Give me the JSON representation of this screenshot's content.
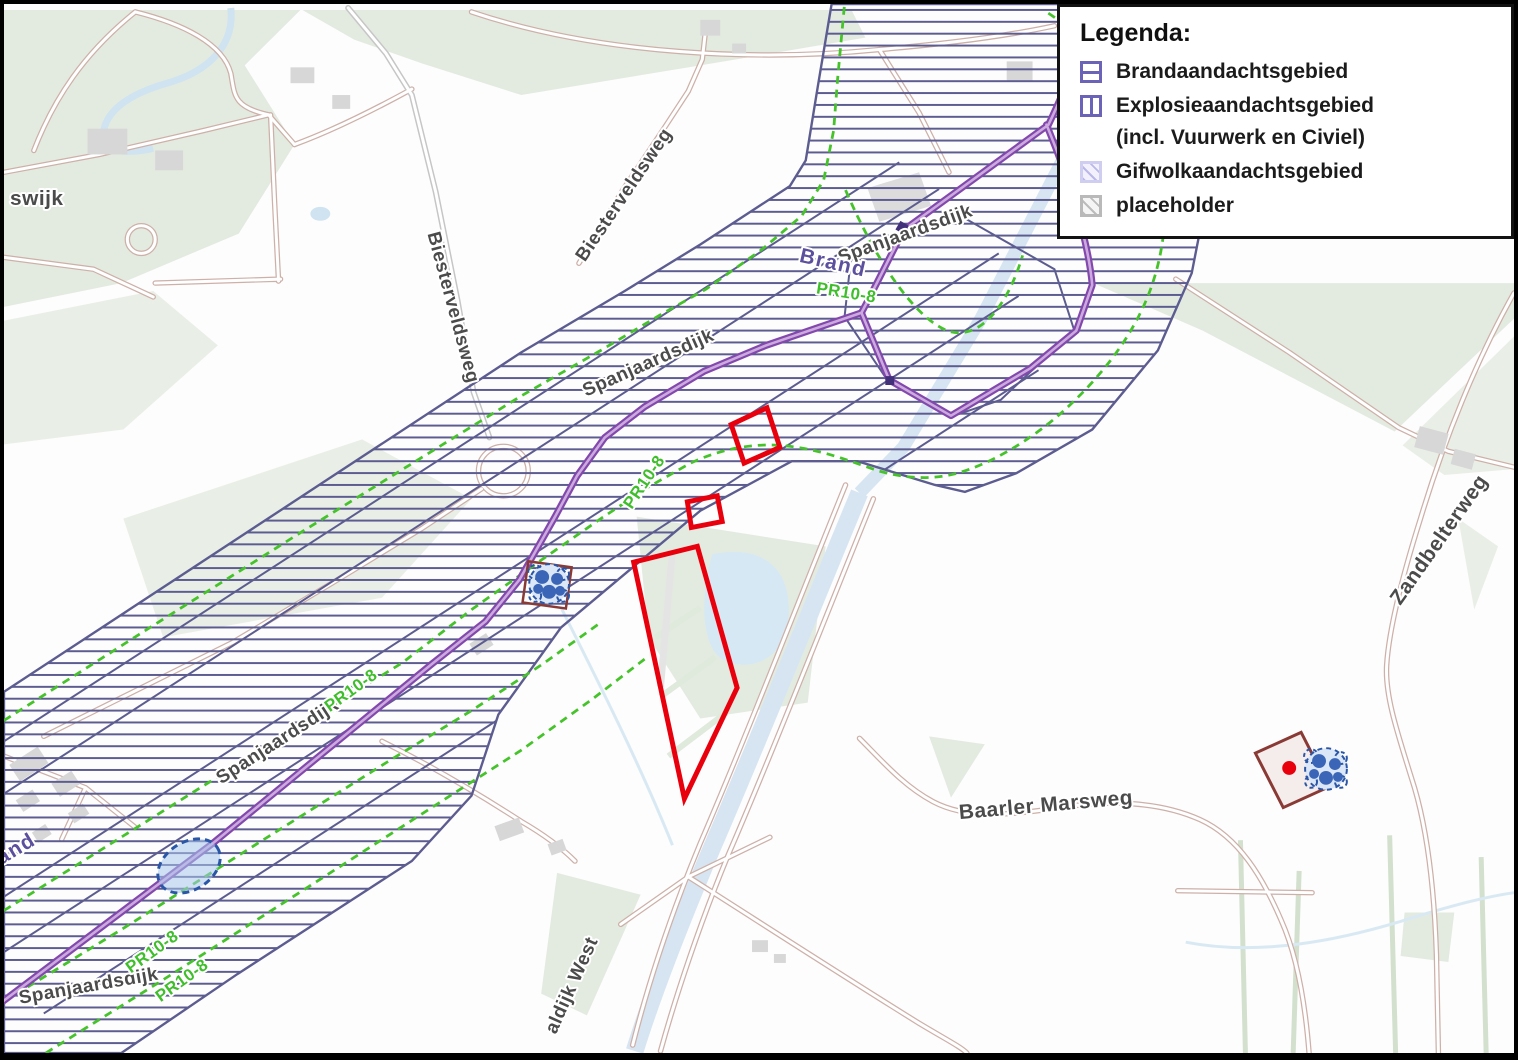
{
  "legend": {
    "title": "Legenda:",
    "items": [
      {
        "id": "brand",
        "label": "Brandaandachtsgebied",
        "swatch": "purple-square-hline",
        "color": "#6b63b8"
      },
      {
        "id": "explosie",
        "label": "Explosieaandachtsgebied",
        "swatch": "purple-square-vline",
        "color": "#6b63b8"
      },
      {
        "id": "explosie-note",
        "label": "(incl. Vuurwerk en Civiel)",
        "swatch": "none"
      },
      {
        "id": "gifwolk",
        "label": "Gifwolkaandachtsgebied",
        "swatch": "lavender-hatch",
        "color": "#cfcdf0"
      },
      {
        "id": "placeholder",
        "label": "placeholder",
        "swatch": "gray-hatch",
        "color": "#b9b9b9"
      }
    ]
  },
  "map": {
    "road_labels": [
      "swijk",
      "Biesterveldsweg",
      "Biesterveldsweg",
      "Spanjaardsdijk",
      "Spanjaardsdijk",
      "Spanjaardsdijk",
      "Spanjaardsdijk",
      "Baarler Marsweg",
      "Zandbelterweg",
      "aldijk West"
    ],
    "hazard_route_labels": [
      "Brand",
      "Brand"
    ],
    "risk_contour_labels": [
      "PR10-8",
      "PR10-8",
      "PR10-8",
      "PR10-8",
      "PR10-8"
    ],
    "colors": {
      "hatch_area_outline": "#5c5c90",
      "hazard_route": "#8248ad",
      "risk_contour_dashed": "#46c32b",
      "highlight_polygon": "#e8000d",
      "gas_cloud_marker": "#2a56a8",
      "field_green": "#e3ebe1",
      "water_blue": "#d6e5f1"
    }
  }
}
